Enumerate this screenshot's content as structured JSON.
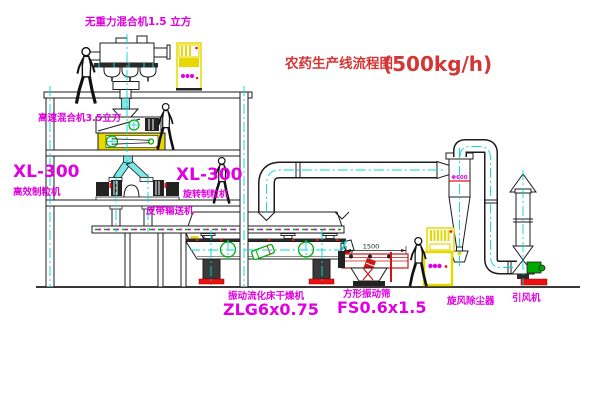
{
  "title": {
    "text": "农药生产线流程图",
    "capacity": "(500kg/h)"
  },
  "equipment_labels": {
    "gravity_mixer": "无重力混合机1.5 立方",
    "high_speed_mixer": "高速混合机3.5立方",
    "granulator_left": {
      "model": "XL-300",
      "name": "高效制粒机"
    },
    "granulator_right": {
      "model": "XL-300",
      "name": "旋转制粒机"
    },
    "belt_conveyor": "皮带输送机",
    "fluid_bed_dryer": {
      "name": "振动流化床干燥机",
      "model": "ZLG6x0.75"
    },
    "vibrating_screen": {
      "name": "方形振动筛",
      "model": "FS0.6x1.5",
      "dimension": "1500"
    },
    "cyclone": {
      "name": "旋风除尘器",
      "mark": "Φ600"
    },
    "draft_fan": "引风机"
  },
  "colors": {
    "line": "#1c1c1c",
    "magenta": "#e000e0",
    "title_red": "#d43535",
    "yellow": "#e6d800",
    "green": "#00aa00",
    "cyan": "#00d8d8",
    "accent_red": "#ee1111"
  }
}
